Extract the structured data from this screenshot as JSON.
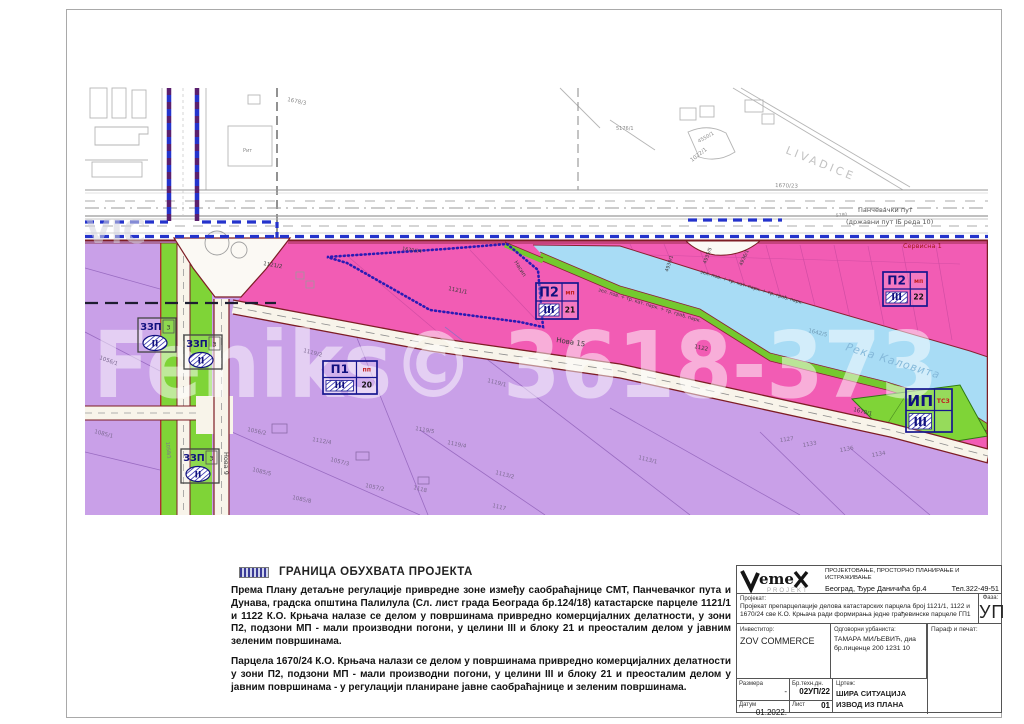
{
  "legend": {
    "title": "ГРАНИЦА ОБУХВАТА ПРОЈЕКТА",
    "p1": "Према Плану детаљне регулације привредне зоне између саобраћајнице СМТ, Панчевачког пута и Дунава, градска општина Палилула (Сл. лист града Београда бр.124/18) катастарске парцеле 1121/1 и 1122 К.О. Крњача налазе се делом у површинама привредно комерцијалних делатности, у зони П2, подзони МП - мали производни погони, у целини III и блоку 21 и преосталим делом у јавним зеленим површинама.",
    "p2": "Парцела 1670/24 К.О. Крњача налази се делом у површинама привредно комерцијалних делатности у зони П2, подзони МП - мали производни погони, у целини III и блоку 21 и преосталим делом у јавним површинама - у регулацији планиране јавне саобраћајнице и зеленим површинама."
  },
  "titleblock": {
    "logo_main": "eme",
    "logo_sub": "PROJEKT",
    "company_line1": "ПРОЈЕКТОВАЊЕ, ПРОСТОРНО ПЛАНИРАЊЕ И ИСТРАЖИВАЊЕ",
    "company_line2": "Београд, Ђуре Даничића бр.4",
    "phone": "Тел.322-49-51",
    "project_label": "Пројекат:",
    "project_text": "Пројекат препарцелације делова катастарских парцела број 1121/1, 1122 и 1670/24 све К.О. Крњача ради формирања једне грађевинске парцеле ГП1",
    "faza_label": "Фаза:",
    "faza_value": "УП",
    "investor_label": "Инвеститор:",
    "investor_value": "ZOV COMMERCE",
    "urbanist_label": "Одговорни урбаниста:",
    "urbanist_name": "ТАМАРА МИЉЕВИЋ, диа",
    "urbanist_license": "бр.лиценце 200 1231 10",
    "paraf_label": "Параф и печат:",
    "razmera_label": "Размера",
    "razmera_value": "-",
    "brtehn_label": "Бр.техн.дн.",
    "brtehn_value": "02УП/22",
    "crtez_label": "Цртеж:",
    "crtez_line1": "ШИРА СИТУАЦИЈА",
    "crtez_line2": "ИЗВОД ИЗ ПЛАНА",
    "datum_label": "Датум",
    "datum_value": "01.2022.",
    "list_label": "Лист",
    "list_value": "01"
  },
  "map": {
    "colors": {
      "gray": "#8a8a8a",
      "purp": "#7d6a92",
      "dk": "#3c3c3c",
      "road": "#555555",
      "dkred": "#a01818",
      "water": "#85b9da",
      "waterdk": "#6f9ab5",
      "faint": "#c2c2c2",
      "wm": "#ffffff",
      "wm2": "#d4d4de",
      "zone_pink": "#f25cb4",
      "zone_purple": "#c9a0e8",
      "zone_green": "#7fd437",
      "zone_water": "#a8dcf5",
      "boundary_blue": "#2433cc",
      "boundary_dot": "#2a1bb5",
      "road_edge": "#7d1d24",
      "stamp_navy": "#10107e",
      "stamp_red": "#c22222"
    },
    "labels": [
      {
        "n": "livadice",
        "t": "LIVADICE",
        "x": 785,
        "y": 153,
        "s": 11,
        "r": 22,
        "c": "faint",
        "ls": 3
      },
      {
        "n": "road-name-1",
        "t": "Панчевачки пут",
        "x": 858,
        "y": 212,
        "s": 6.5,
        "c": "road"
      },
      {
        "n": "road-name-2",
        "t": "(државни пут IБ реда 10)",
        "x": 846,
        "y": 224,
        "s": 6.5,
        "c": "road"
      },
      {
        "n": "road-chainage",
        "t": "5780",
        "x": 836,
        "y": 217,
        "s": 4.5,
        "r": -6,
        "c": "gray"
      },
      {
        "n": "servisna-1",
        "t": "Сервисна 1",
        "x": 903,
        "y": 248,
        "s": 6.5,
        "c": "dkred"
      },
      {
        "n": "reka-kalovita",
        "t": "Река Каловита",
        "x": 845,
        "y": 350,
        "s": 11,
        "r": 17,
        "c": "water",
        "i": 1,
        "ls": 1
      },
      {
        "n": "nova-15",
        "t": "Нова 15",
        "x": 556,
        "y": 342,
        "s": 7,
        "r": 9,
        "c": "dk"
      },
      {
        "n": "nova-9",
        "t": "Нова 9",
        "x": 224,
        "y": 452,
        "s": 6.5,
        "r": 90,
        "c": "dk"
      },
      {
        "n": "nasip",
        "t": "Насип",
        "x": 514,
        "y": 262,
        "s": 5.5,
        "r": 58,
        "c": "dk"
      },
      {
        "n": "bank-text-1",
        "t": "зел. пов. + тр. кат. парк. + тр. грађ. парк.",
        "x": 598,
        "y": 291,
        "s": 4.8,
        "r": 17,
        "c": "dk"
      },
      {
        "n": "bank-text-2",
        "t": "зел. пов. + тр. кат. парк. + тр. грађ. парк.",
        "x": 700,
        "y": 273,
        "s": 4.8,
        "r": 17,
        "c": "dk"
      },
      {
        "t": "1678/3",
        "x": 287,
        "y": 101,
        "s": 5.5,
        "r": 12,
        "c": "gray"
      },
      {
        "t": "1022/1",
        "x": 692,
        "y": 162,
        "s": 5.5,
        "r": -38,
        "c": "gray"
      },
      {
        "t": "4550/1",
        "x": 699,
        "y": 143,
        "s": 5,
        "r": -30,
        "c": "gray"
      },
      {
        "t": "5176/1",
        "x": 616,
        "y": 130,
        "s": 5,
        "c": "gray"
      },
      {
        "t": "1670/23",
        "x": 775,
        "y": 187,
        "s": 5.5,
        "r": 2,
        "c": "gray"
      },
      {
        "t": "Рит",
        "x": 243,
        "y": 152,
        "s": 5,
        "c": "gray"
      },
      {
        "t": "1121/1",
        "x": 448,
        "y": 290,
        "s": 5.5,
        "r": 12,
        "c": "dk"
      },
      {
        "t": "1121/2",
        "x": 263,
        "y": 265,
        "s": 5.5,
        "r": 10,
        "c": "dk"
      },
      {
        "t": "1670/24",
        "x": 402,
        "y": 250,
        "s": 4.8,
        "r": 9,
        "c": "dk"
      },
      {
        "t": "1122",
        "x": 694,
        "y": 348,
        "s": 5.5,
        "r": 12,
        "c": "dk"
      },
      {
        "t": "1670/1",
        "x": 853,
        "y": 411,
        "s": 5.5,
        "r": 14,
        "c": "dk"
      },
      {
        "t": "1642/5",
        "x": 808,
        "y": 332,
        "s": 5.5,
        "r": 14,
        "c": "waterdk"
      },
      {
        "t": "4930/1",
        "x": 668,
        "y": 272,
        "s": 4.8,
        "r": -72,
        "c": "dk"
      },
      {
        "t": "4935/5",
        "x": 706,
        "y": 264,
        "s": 4.8,
        "r": -70,
        "c": "dk"
      },
      {
        "t": "4936/1",
        "x": 742,
        "y": 266,
        "s": 4.8,
        "r": -66,
        "c": "dk"
      },
      {
        "t": "1119/2",
        "x": 303,
        "y": 352,
        "s": 5.5,
        "r": 14,
        "c": "purp"
      },
      {
        "t": "1119/1",
        "x": 487,
        "y": 382,
        "s": 5.5,
        "r": 14,
        "c": "purp"
      },
      {
        "t": "1112/4",
        "x": 312,
        "y": 441,
        "s": 5.5,
        "r": 10,
        "c": "purp"
      },
      {
        "t": "1056/2",
        "x": 247,
        "y": 431,
        "s": 5.5,
        "r": 12,
        "c": "purp"
      },
      {
        "t": "1057/3",
        "x": 330,
        "y": 461,
        "s": 5.5,
        "r": 14,
        "c": "purp"
      },
      {
        "t": "1085/5",
        "x": 252,
        "y": 471,
        "s": 5.5,
        "r": 14,
        "c": "purp"
      },
      {
        "t": "1085/8",
        "x": 292,
        "y": 499,
        "s": 5.5,
        "r": 12,
        "c": "purp"
      },
      {
        "t": "1057/2",
        "x": 365,
        "y": 487,
        "s": 5.5,
        "r": 12,
        "c": "purp"
      },
      {
        "t": "1119/5",
        "x": 415,
        "y": 430,
        "s": 5.5,
        "r": 10,
        "c": "purp"
      },
      {
        "t": "1119/4",
        "x": 447,
        "y": 444,
        "s": 5.5,
        "r": 12,
        "c": "purp"
      },
      {
        "t": "1113/2",
        "x": 495,
        "y": 474,
        "s": 5.5,
        "r": 14,
        "c": "purp"
      },
      {
        "t": "1118",
        "x": 413,
        "y": 489,
        "s": 5.5,
        "r": 14,
        "c": "purp"
      },
      {
        "t": "1117",
        "x": 492,
        "y": 507,
        "s": 5.5,
        "r": 14,
        "c": "purp"
      },
      {
        "t": "1113/1",
        "x": 638,
        "y": 459,
        "s": 5.5,
        "r": 14,
        "c": "purp"
      },
      {
        "t": "1127",
        "x": 780,
        "y": 442,
        "s": 5.5,
        "r": -8,
        "c": "purp"
      },
      {
        "t": "1133",
        "x": 803,
        "y": 447,
        "s": 5.5,
        "r": -10,
        "c": "purp"
      },
      {
        "t": "1136",
        "x": 840,
        "y": 452,
        "s": 5.5,
        "r": -10,
        "c": "purp"
      },
      {
        "t": "1134",
        "x": 872,
        "y": 457,
        "s": 5.5,
        "r": -10,
        "c": "purp"
      },
      {
        "t": "1056/1",
        "x": 99,
        "y": 359,
        "s": 5.5,
        "r": 20,
        "c": "purp"
      },
      {
        "t": "1085/1",
        "x": 94,
        "y": 433,
        "s": 5.5,
        "r": 15,
        "c": "purp"
      },
      {
        "t": "1058/1",
        "x": 166,
        "y": 442,
        "s": 4.8,
        "r": 84,
        "c": "purp"
      }
    ],
    "watermarks": [
      {
        "n": "watermark-main",
        "t": "Feniks© 3618-373",
        "x": 93,
        "y": 397,
        "s": 92,
        "c": "wm",
        "o": 0.5,
        "len": 845,
        "w": "bold"
      },
      {
        "n": "watermark-corner",
        "t": "VIC",
        "x": 86,
        "y": 243,
        "s": 32,
        "c": "wm2",
        "o": 0.55,
        "w": "bold"
      }
    ],
    "stamps": [
      {
        "id": "p2-block21",
        "type": "zone",
        "x": 536,
        "y": 283,
        "w": 42,
        "h": 36,
        "main": "П2",
        "sub": "мп",
        "roman": "III",
        "num": "21"
      },
      {
        "id": "p2-block22",
        "type": "zone",
        "x": 883,
        "y": 272,
        "w": 44,
        "h": 34,
        "main": "П2",
        "sub": "мп",
        "roman": "III",
        "num": "22"
      },
      {
        "id": "p1-block20",
        "type": "zone",
        "x": 323,
        "y": 361,
        "w": 54,
        "h": 33,
        "main": "П1",
        "sub": "пп",
        "roman": "III",
        "num": "20"
      },
      {
        "id": "ip-ts3",
        "type": "zone",
        "x": 906,
        "y": 389,
        "w": 46,
        "h": 43,
        "main": "ИП",
        "sub": "ТС3",
        "roman": "III",
        "num": ""
      },
      {
        "id": "zzp-1",
        "type": "zzp",
        "x": 138,
        "y": 318,
        "w": 38,
        "h": 34,
        "main": "ЗЗП",
        "sub": "3",
        "roman": "II"
      },
      {
        "id": "zzp-2",
        "type": "zzp",
        "x": 184,
        "y": 335,
        "w": 38,
        "h": 34,
        "main": "ЗЗП",
        "sub": "3",
        "roman": "II"
      },
      {
        "id": "zzp-3",
        "type": "zzp",
        "x": 181,
        "y": 449,
        "w": 38,
        "h": 34,
        "main": "ЗЗП",
        "sub": "3",
        "roman": "II"
      }
    ]
  }
}
